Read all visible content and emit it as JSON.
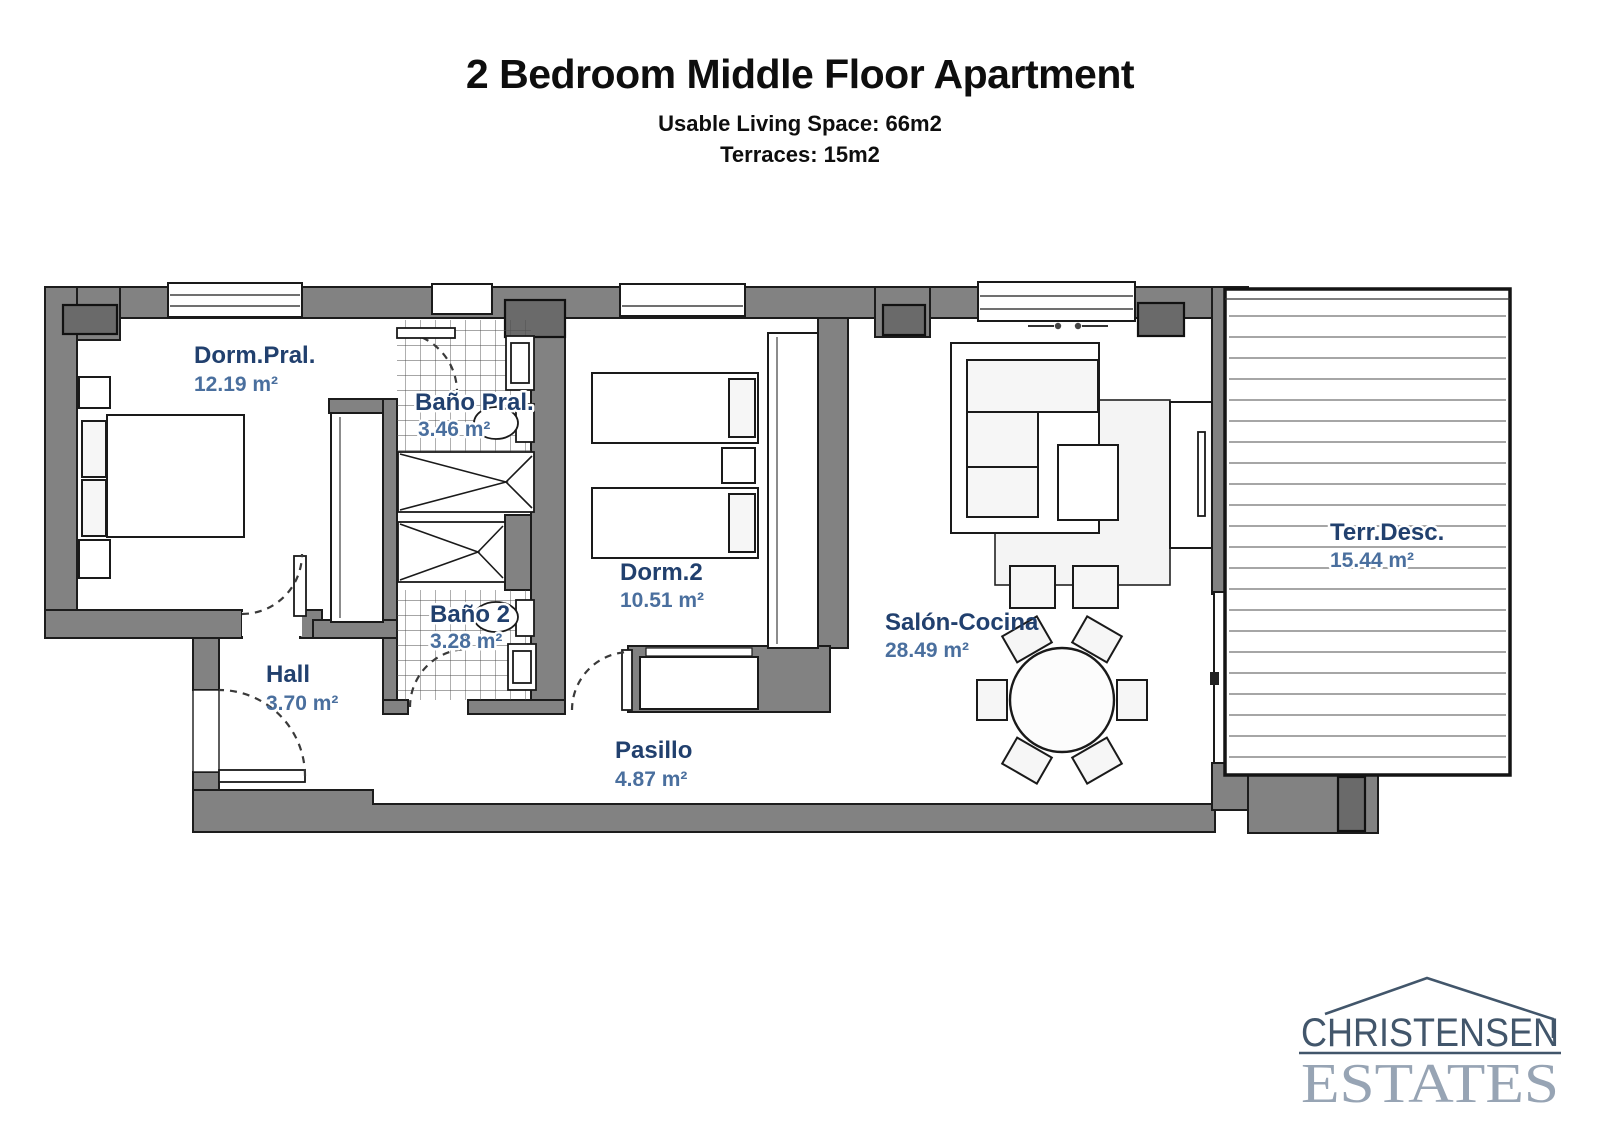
{
  "header": {
    "title": "2 Bedroom Middle Floor Apartment",
    "subtitle_living": "Usable Living Space: 66m2",
    "subtitle_terrace": "Terraces: 15m2"
  },
  "rooms": [
    {
      "id": "dorm-pral",
      "name": "Dorm.Pral.",
      "area": "12.19 m²"
    },
    {
      "id": "bano-pral",
      "name": "Baño Pral.",
      "area": "3.46 m²"
    },
    {
      "id": "dorm-2",
      "name": "Dorm.2",
      "area": "10.51 m²"
    },
    {
      "id": "bano-2",
      "name": "Baño 2",
      "area": "3.28 m²"
    },
    {
      "id": "hall",
      "name": "Hall",
      "area": "3.70 m²"
    },
    {
      "id": "pasillo",
      "name": "Pasillo",
      "area": "4.87 m²"
    },
    {
      "id": "salon",
      "name": "Salón-Cocina",
      "area": "28.49 m²"
    },
    {
      "id": "terraza",
      "name": "Terr.Desc.",
      "area": "15.44 m²"
    }
  ],
  "logo": {
    "line1": "CHRISTENSEN",
    "line2": "ESTATES"
  },
  "colors": {
    "wall": "#828282",
    "pillar": "#6a6a6a",
    "room_name": "#21406e",
    "room_area": "#4a6f9e",
    "logo_dark": "#42566b",
    "logo_light": "#97a4b4"
  }
}
